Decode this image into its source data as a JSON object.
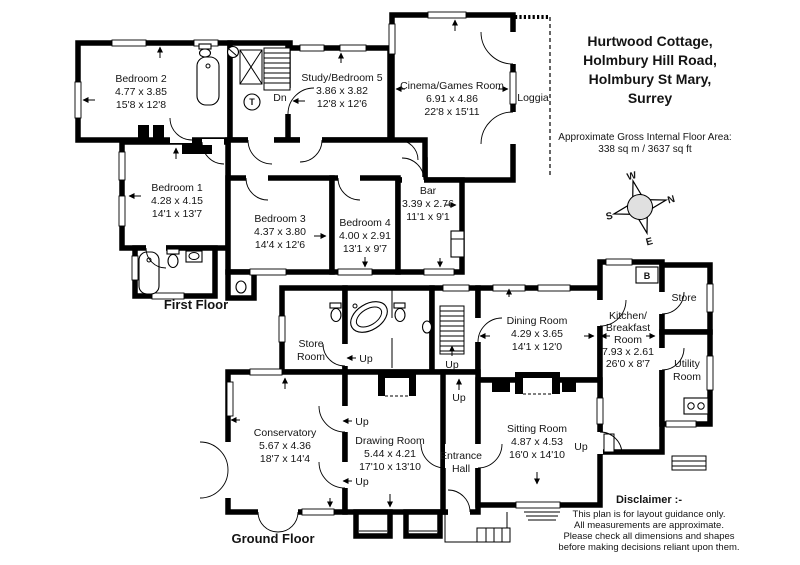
{
  "header": {
    "address_lines": [
      "Hurtwood Cottage,",
      "Holmbury Hill Road,",
      "Holmbury St Mary,",
      "Surrey"
    ],
    "area_label": "Approximate Gross Internal Floor Area:",
    "area_value": "338 sq m / 3637 sq ft"
  },
  "compass": {
    "north": "N",
    "east": "E",
    "south": "S",
    "west": "W"
  },
  "colors": {
    "wall": "#000000",
    "paper": "#ffffff",
    "compass_fill": "#e0e0e0"
  },
  "first_floor": {
    "label": "First Floor",
    "stairs_down": "Dn",
    "tank": "T",
    "rooms": {
      "bedroom2": {
        "name": "Bedroom 2",
        "metric": "4.77 x 3.85",
        "imperial": "15'8 x 12'8"
      },
      "bedroom1": {
        "name": "Bedroom 1",
        "metric": "4.28 x 4.15",
        "imperial": "14'1 x 13'7"
      },
      "bedroom3": {
        "name": "Bedroom 3",
        "metric": "4.37 x 3.80",
        "imperial": "14'4 x 12'6"
      },
      "bedroom4": {
        "name": "Bedroom 4",
        "metric": "4.00 x 2.91",
        "imperial": "13'1 x 9'7"
      },
      "study_bedroom5": {
        "name": "Study/Bedroom 5",
        "metric": "3.86 x 3.82",
        "imperial": "12'8 x 12'6"
      },
      "cinema": {
        "name": "Cinema/Games Room",
        "metric": "6.91 x 4.86",
        "imperial": "22'8 x 15'11"
      },
      "bar": {
        "name": "Bar",
        "metric": "3.39 x 2.76",
        "imperial": "11'1 x 9'1"
      },
      "loggia": {
        "name": "Loggia"
      }
    }
  },
  "ground_floor": {
    "label": "Ground Floor",
    "stairs_up": "Up",
    "boiler": "B",
    "rooms": {
      "dining": {
        "name": "Dining Room",
        "metric": "4.29 x 3.65",
        "imperial": "14'1 x 12'0"
      },
      "sitting": {
        "name": "Sitting Room",
        "metric": "4.87 x 4.53",
        "imperial": "16'0 x 14'10"
      },
      "drawing": {
        "name": "Drawing Room",
        "metric": "5.44 x 4.21",
        "imperial": "17'10 x 13'10"
      },
      "conservatory": {
        "name": "Conservatory",
        "metric": "5.67 x 4.36",
        "imperial": "18'7 x 14'4"
      },
      "kitchen": {
        "line1": "Kitchen/",
        "line2": "Breakfast",
        "line3": "Room",
        "metric": "7.93 x 2.61",
        "imperial": "26'0 x 8'7"
      },
      "entrance": {
        "line1": "Entrance",
        "line2": "Hall"
      },
      "store_room": {
        "line1": "Store",
        "line2": "Room"
      },
      "store": {
        "name": "Store"
      },
      "utility": {
        "line1": "Utility",
        "line2": "Room"
      }
    }
  },
  "disclaimer": {
    "title": "Disclaimer :-",
    "lines": [
      "This plan is for layout guidance only.",
      "All measurements are approximate.",
      "Please check all dimensions and shapes",
      "before making decisions reliant upon them."
    ]
  }
}
